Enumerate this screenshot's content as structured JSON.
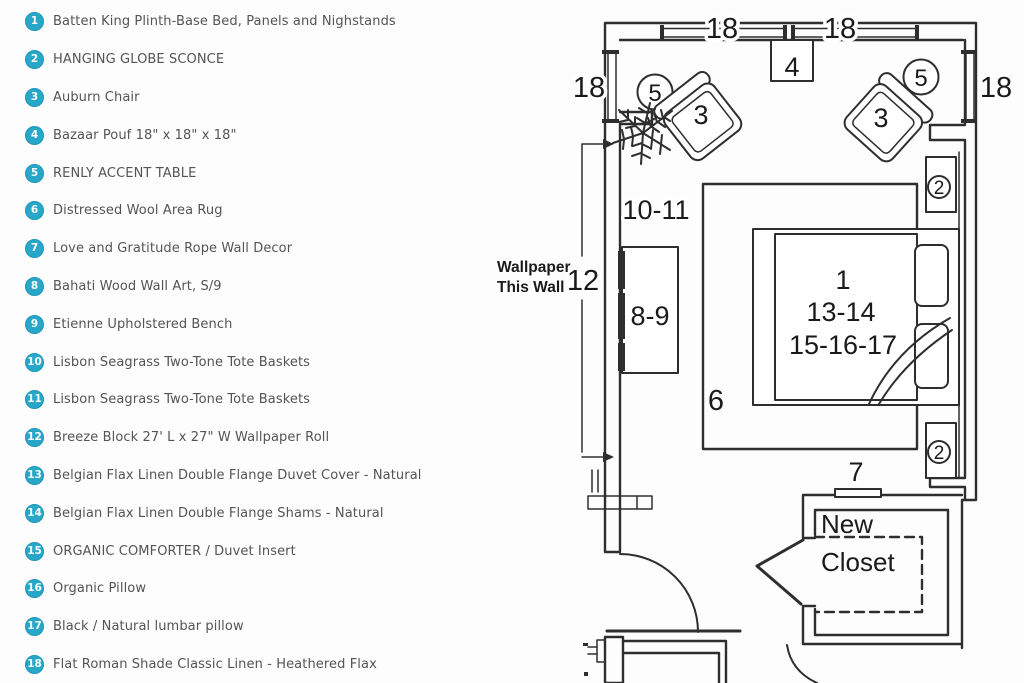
{
  "legend": {
    "items": [
      {
        "num": "1",
        "label": "Batten King Plinth-Base Bed, Panels and Nighstands"
      },
      {
        "num": "2",
        "label": "HANGING GLOBE SCONCE"
      },
      {
        "num": "3",
        "label": "Auburn Chair"
      },
      {
        "num": "4",
        "label": "Bazaar Pouf 18\" x 18\" x 18\""
      },
      {
        "num": "5",
        "label": "RENLY ACCENT TABLE"
      },
      {
        "num": "6",
        "label": "Distressed Wool Area Rug"
      },
      {
        "num": "7",
        "label": "Love and Gratitude Rope Wall Decor"
      },
      {
        "num": "8",
        "label": "Bahati Wood Wall Art, S/9"
      },
      {
        "num": "9",
        "label": "Etienne Upholstered Bench"
      },
      {
        "num": "10",
        "label": "Lisbon Seagrass Two-Tone Tote Baskets"
      },
      {
        "num": "11",
        "label": "Lisbon Seagrass Two-Tone Tote Baskets"
      },
      {
        "num": "12",
        "label": "Breeze Block 27' L x 27\" W Wallpaper Roll"
      },
      {
        "num": "13",
        "label": "Belgian Flax Linen Double Flange Duvet Cover - Natural"
      },
      {
        "num": "14",
        "label": "Belgian Flax Linen Double Flange Shams - Natural"
      },
      {
        "num": "15",
        "label": "ORGANIC COMFORTER / Duvet Insert"
      },
      {
        "num": "16",
        "label": "Organic Pillow"
      },
      {
        "num": "17",
        "label": "Black / Natural lumbar pillow"
      },
      {
        "num": "18",
        "label": "Flat Roman Shade Classic Linen - Heathered Flax"
      }
    ]
  },
  "plan": {
    "labels": {
      "dim_top_a": "18",
      "dim_top_b": "18",
      "dim_left": "18",
      "dim_right": "18",
      "pouf": "4",
      "table_left": "5",
      "table_right": "5",
      "chair_left": "3",
      "chair_right": "3",
      "sconce_top": "2",
      "sconce_bottom": "2",
      "baskets": "10-11",
      "wallpaper_dim": "12",
      "bench": "8-9",
      "rug": "6",
      "rope": "7",
      "bed_line1": "1",
      "bed_line2": "13-14",
      "bed_line3": "15-16-17"
    },
    "notes": {
      "wallpaper_line1": "Wallpaper",
      "wallpaper_line2": "This Wall",
      "closet_line1": "New",
      "closet_line2": "Closet"
    }
  },
  "colors": {
    "badge": "#28a7c9",
    "legend_text": "#545454",
    "plan_ink": "#2e2e2e",
    "plan_text": "#1a1a1a",
    "background": "#fdfdfd"
  }
}
